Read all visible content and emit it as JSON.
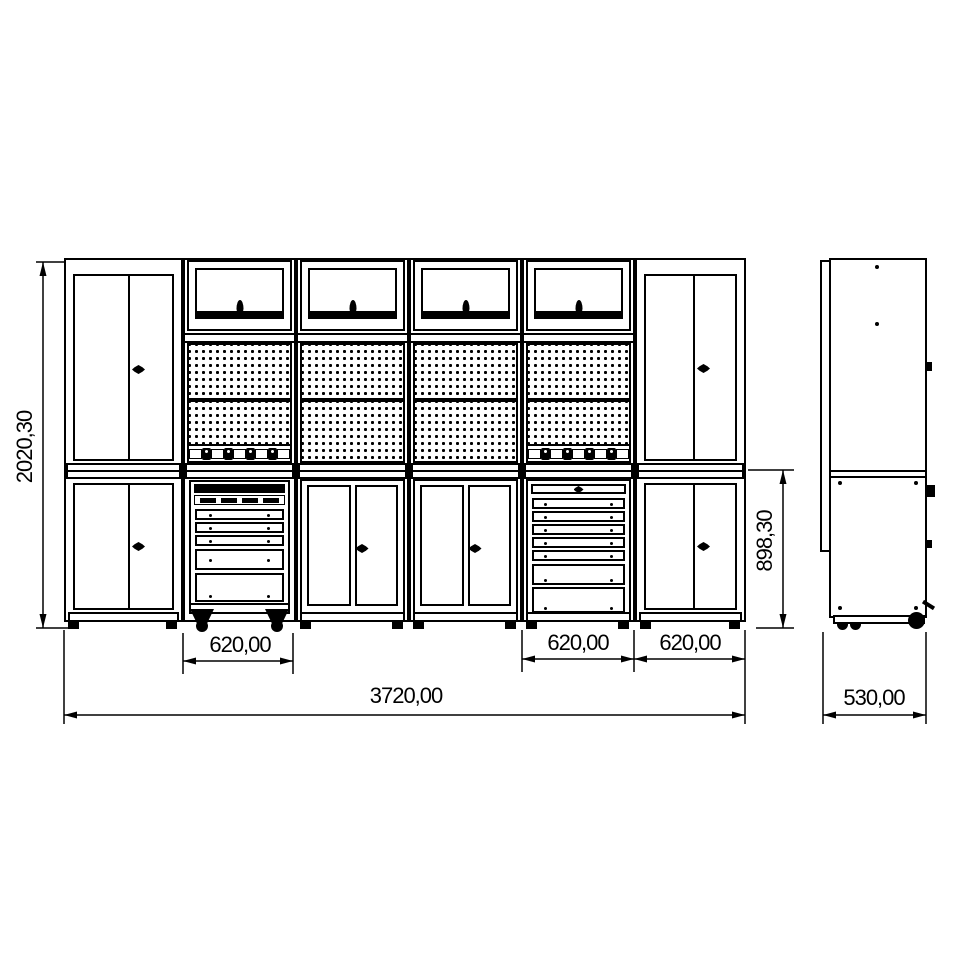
{
  "drawing": {
    "type": "technical-drawing",
    "views": {
      "front": "workshop cabinet wall front elevation",
      "side": "side elevation"
    },
    "dimensions": {
      "overall_height": "2020,30",
      "bench_height": "898,30",
      "module_width_1": "620,00",
      "module_width_2": "620,00",
      "module_width_3": "620,00",
      "overall_width": "3720,00",
      "depth": "530,00"
    },
    "line_color": "#000000",
    "background_color": "#ffffff"
  }
}
